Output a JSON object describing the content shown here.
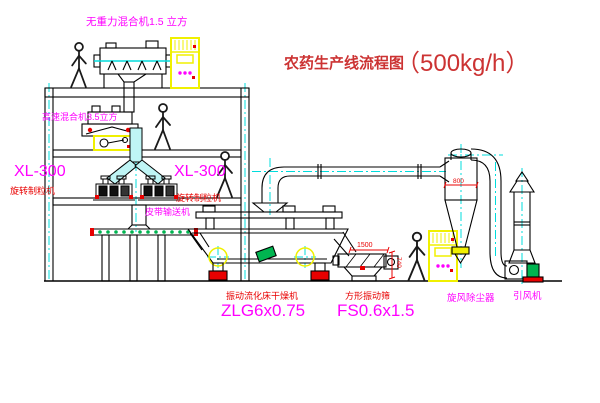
{
  "title": {
    "name": "农药生产线流程图",
    "capacity": "（500kg/h）"
  },
  "equipment_labels": {
    "gravity_free_mixer": "无重力混合机1.5 立方",
    "high_speed_mixer": "高速混合机3.5立方",
    "granulator_left_model": "XL-300",
    "granulator_left_name": "旋转制粒机",
    "granulator_right_model": "XL-300",
    "granulator_right_name": "旋转制粒机",
    "belt_conveyor": "皮带输送机",
    "fluid_bed_dryer_name": "振动流化床干燥机",
    "fluid_bed_dryer_model": "ZLG6x0.75",
    "vibrating_screen_name": "方形振动筛",
    "vibrating_screen_model": "FS0.6x1.5",
    "cyclone_dust_collector": "旋风除尘器",
    "induced_draft_fan": "引风机"
  },
  "dimensions": {
    "screen_length": "1500",
    "screen_height": "740",
    "cyclone_diameter": "800"
  },
  "icons": {
    "control_cabinet_lights": "three-magenta-indicator-dots"
  },
  "colors": {
    "outline": "#000000",
    "label_magenta": "#FF00FF",
    "label_red": "#E80000",
    "title_red": "#CC3333",
    "equipment_yellow": "#F0F000",
    "centerline_cyan": "#00DCDC",
    "accent_green": "#00B450",
    "background": "#FFFFFF"
  }
}
